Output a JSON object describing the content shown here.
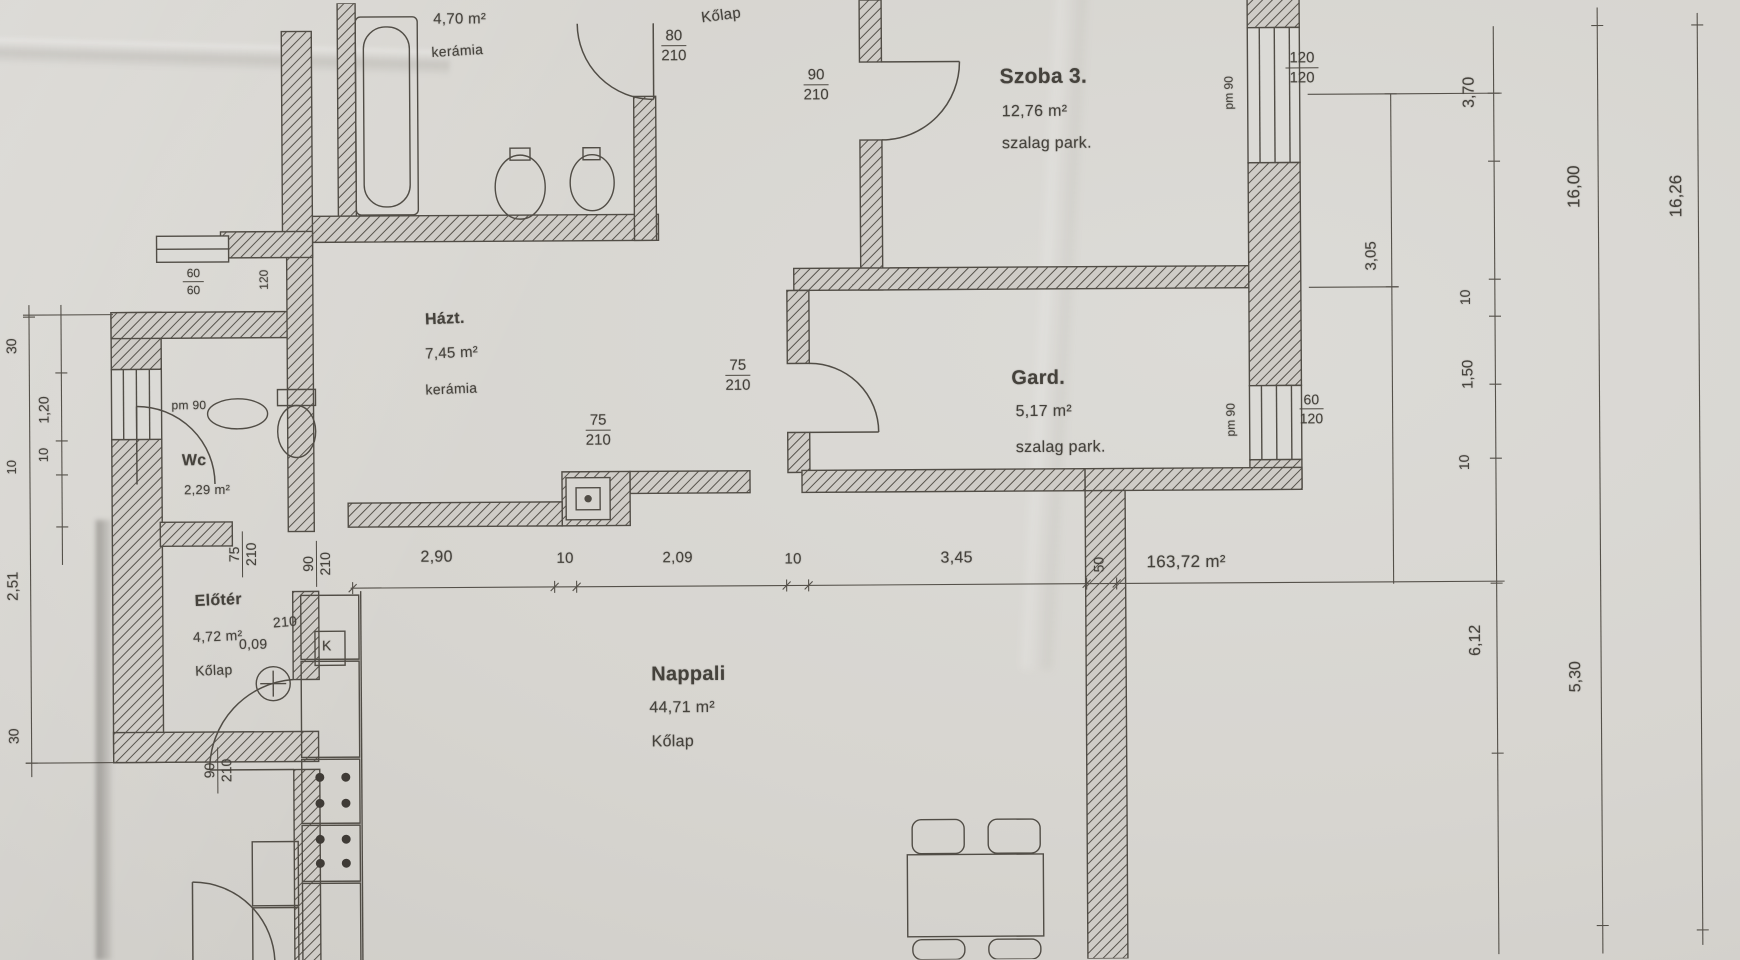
{
  "plan_title": "lakás alaprajz (floor plan scan)",
  "rooms": {
    "bath": {
      "area": "4,70 m²",
      "floor": "kerámia"
    },
    "corridor": {
      "floor": "Kőlap"
    },
    "szoba3": {
      "name": "Szoba 3.",
      "area": "12,76 m²",
      "floor": "szalag park."
    },
    "gard": {
      "name": "Gard.",
      "area": "5,17 m²",
      "floor": "szalag park."
    },
    "hazt": {
      "name": "Házt.",
      "area": "7,45 m²",
      "floor": "kerámia"
    },
    "wc": {
      "name": "Wc",
      "area": "2,29 m²"
    },
    "eloter": {
      "name": "Előtér",
      "area": "4,72 m²",
      "floor": "Kőlap"
    },
    "nappali": {
      "name": "Nappali",
      "area": "44,71 m²",
      "floor": "Kőlap"
    },
    "total": {
      "area": "163,72 m²"
    }
  },
  "dims": {
    "bottom": {
      "d1": "2,90",
      "d2": "10",
      "d3": "2,09",
      "d4": "10",
      "d5": "3,45",
      "wall": "50"
    },
    "right": {
      "r1": "3,70",
      "r2": "3,05",
      "r3": "10",
      "r4": "1,50",
      "r5": "10",
      "r6": "6,12",
      "r7": "5,30",
      "total1": "16,00",
      "total2": "16,26"
    },
    "left": {
      "l1": "30",
      "l2": "1,20",
      "l3": "10",
      "l4": "10",
      "l5": "2,51",
      "l6": "30"
    },
    "small": {
      "a": "0,09",
      "k": "K",
      "n60a": "60",
      "n60b": "60",
      "n120": "120"
    }
  },
  "openings": {
    "door80": {
      "w": "80",
      "h": "210"
    },
    "door90a": {
      "w": "90",
      "h": "210"
    },
    "door75a": {
      "w": "75",
      "h": "210"
    },
    "door75b": {
      "w": "75",
      "h": "210"
    },
    "door75wc": {
      "w": "75",
      "h": "210"
    },
    "door90el": {
      "w": "90",
      "h": "210"
    },
    "door90el_extra": "210",
    "door90k": {
      "w": "90",
      "h": "210"
    },
    "win120": {
      "w": "120",
      "h": "120"
    },
    "win60": {
      "w": "60",
      "h": "120"
    },
    "sill1": "pm 90",
    "sill2": "pm 90",
    "sill3": "pm 90"
  },
  "colors": {
    "ink": "#4d4942",
    "paper": "#d7d5d0",
    "wall_fill": "#cfccc7"
  }
}
